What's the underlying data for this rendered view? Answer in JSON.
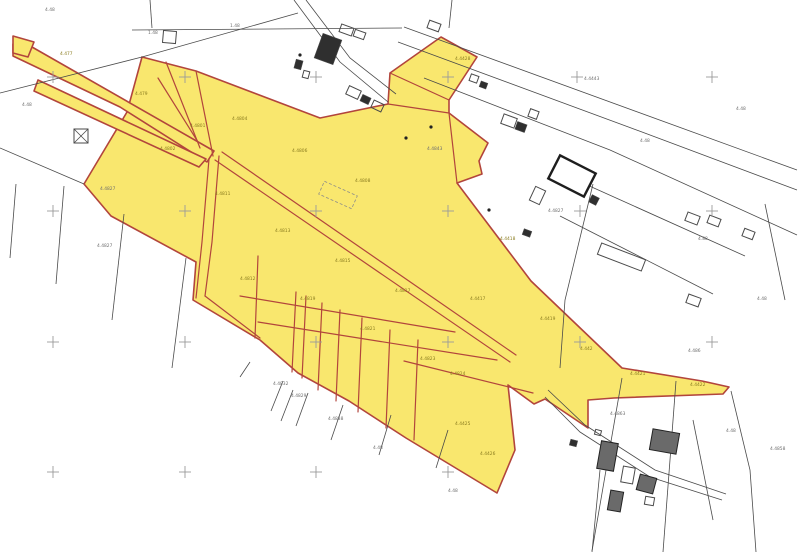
{
  "map": {
    "title": "cadastral-parcel-map",
    "canvas": {
      "width": 800,
      "height": 552,
      "background": "#ffffff"
    },
    "colors": {
      "parcel_fill": "#F9E76E",
      "parcel_stroke": "#B2453C",
      "line_black": "#4a4a4a",
      "cross_gray": "#9a9a9a",
      "label_white_area": "#6f6f6f",
      "label_yellow_area": "#8a7c1f",
      "building_fill": "#2f2f2f",
      "building_hatch": "#6a6a6a",
      "dashed_gray": "#8b8b8b"
    },
    "highlighted_parcels": [
      {
        "name": "main-parcel-block",
        "points": "142,57 196,71 320,118 388,104 390,73 441,37 477,57 449,100 449,113 488,143 479,161 482,174 457,183 531,281 622,368 702,381 729,387 723,394 614,398 588,400 588,428 545,399 534,404 508,385 515,450 497,493 406,438 349,401 298,373 260,340 193,300 196,262 111,216 84,184 127,112"
      },
      {
        "name": "strip-parcel-1",
        "points": "13,44 32,47 214,151 207,162 120,107 13,56"
      },
      {
        "name": "strip-parcel-2",
        "points": "38,80 206,159 199,167 34,91"
      },
      {
        "name": "corner-parcel",
        "points": "13,36 34,42 28,57 13,53"
      }
    ],
    "red_lines": [
      "196,71 213,156",
      "166,62 200,148",
      "158,78 198,142",
      "209,159 202,242 196,298",
      "219,156 212,242 205,296",
      "205,296 260,338",
      "215,160 510,362",
      "222,152 516,355",
      "388,104 449,113",
      "390,73 449,100",
      "258,256 255,338",
      "296,292 292,372",
      "306,296 302,378",
      "322,303 318,390",
      "340,310 336,401",
      "362,318 358,412",
      "390,330 386,428",
      "418,340 414,440",
      "240,296 455,332",
      "258,322 497,360",
      "404,361 533,393",
      "449,113 457,183"
    ],
    "black_lines": [
      "404,27 797,170",
      "398,42 642,132 797,190",
      "424,78 610,150 797,235",
      "294,0 340,62 388,102",
      "306,0 350,58 396,94",
      "0,93 142,57 298,13",
      "132,30 402,28",
      "150,0 152,28",
      "452,0 449,28",
      "0,148 84,184",
      "16,184 10,258",
      "64,186 56,284",
      "124,214 112,320",
      "186,258 172,368",
      "283,381 271,411",
      "293,390 281,421",
      "308,393 296,426",
      "343,405 331,440",
      "391,415 379,455",
      "448,430 436,468",
      "593,184 565,300 560,368",
      "560,216 713,294",
      "585,184 745,256",
      "765,204 785,300",
      "548,390 585,425 655,470 726,494",
      "545,397 580,432 650,477 722,500",
      "600,470 592,552",
      "622,378 592,551",
      "676,381 663,552",
      "731,391 750,470 756,552",
      "693,420 713,520",
      "240,377 250,362"
    ],
    "dashed_rects": [
      {
        "x": 320,
        "y": 188,
        "w": 36,
        "h": 14,
        "rot": 24
      }
    ],
    "buildings": [
      {
        "x": 318,
        "y": 36,
        "w": 20,
        "h": 26,
        "rot": 20,
        "style": "filled"
      },
      {
        "x": 340,
        "y": 26,
        "w": 13,
        "h": 8,
        "rot": 20,
        "style": "outline"
      },
      {
        "x": 354,
        "y": 31,
        "w": 11,
        "h": 7,
        "rot": 20,
        "style": "outline"
      },
      {
        "x": 295,
        "y": 60,
        "w": 7,
        "h": 9,
        "rot": 15,
        "style": "filled"
      },
      {
        "x": 303,
        "y": 71,
        "w": 6,
        "h": 7,
        "rot": 15,
        "style": "outline"
      },
      {
        "x": 347,
        "y": 88,
        "w": 13,
        "h": 9,
        "rot": 25,
        "style": "outline"
      },
      {
        "x": 361,
        "y": 96,
        "w": 9,
        "h": 7,
        "rot": 25,
        "style": "filled"
      },
      {
        "x": 372,
        "y": 102,
        "w": 11,
        "h": 8,
        "rot": 25,
        "style": "outline"
      },
      {
        "x": 163,
        "y": 31,
        "w": 13,
        "h": 12,
        "rot": 5,
        "style": "outline"
      },
      {
        "x": 74,
        "y": 129,
        "w": 14,
        "h": 14,
        "rot": 0,
        "style": "x"
      },
      {
        "x": 428,
        "y": 22,
        "w": 12,
        "h": 8,
        "rot": 20,
        "style": "outline"
      },
      {
        "x": 470,
        "y": 75,
        "w": 8,
        "h": 7,
        "rot": 20,
        "style": "outline"
      },
      {
        "x": 480,
        "y": 82,
        "w": 7,
        "h": 6,
        "rot": 20,
        "style": "filled"
      },
      {
        "x": 502,
        "y": 116,
        "w": 14,
        "h": 10,
        "rot": 20,
        "style": "outline"
      },
      {
        "x": 516,
        "y": 123,
        "w": 10,
        "h": 8,
        "rot": 20,
        "style": "filled"
      },
      {
        "x": 529,
        "y": 110,
        "w": 9,
        "h": 8,
        "rot": 20,
        "style": "outline"
      },
      {
        "x": 552,
        "y": 163,
        "w": 40,
        "h": 26,
        "rot": 27,
        "style": "thick"
      },
      {
        "x": 590,
        "y": 196,
        "w": 8,
        "h": 8,
        "rot": 27,
        "style": "filled"
      },
      {
        "x": 532,
        "y": 188,
        "w": 11,
        "h": 15,
        "rot": 25,
        "style": "outline"
      },
      {
        "x": 523,
        "y": 230,
        "w": 8,
        "h": 6,
        "rot": 20,
        "style": "filled"
      },
      {
        "x": 598,
        "y": 251,
        "w": 47,
        "h": 12,
        "rot": 21,
        "style": "outline"
      },
      {
        "x": 686,
        "y": 214,
        "w": 13,
        "h": 9,
        "rot": 21,
        "style": "outline"
      },
      {
        "x": 708,
        "y": 217,
        "w": 12,
        "h": 8,
        "rot": 21,
        "style": "outline"
      },
      {
        "x": 743,
        "y": 230,
        "w": 11,
        "h": 8,
        "rot": 21,
        "style": "outline"
      },
      {
        "x": 687,
        "y": 296,
        "w": 13,
        "h": 9,
        "rot": 20,
        "style": "outline"
      },
      {
        "x": 651,
        "y": 431,
        "w": 27,
        "h": 21,
        "rot": 10,
        "style": "hatched"
      },
      {
        "x": 599,
        "y": 442,
        "w": 17,
        "h": 28,
        "rot": 10,
        "style": "hatched"
      },
      {
        "x": 622,
        "y": 467,
        "w": 12,
        "h": 16,
        "rot": 10,
        "style": "outline"
      },
      {
        "x": 638,
        "y": 476,
        "w": 17,
        "h": 16,
        "rot": 15,
        "style": "hatched"
      },
      {
        "x": 609,
        "y": 491,
        "w": 13,
        "h": 20,
        "rot": 10,
        "style": "hatched"
      },
      {
        "x": 645,
        "y": 497,
        "w": 9,
        "h": 8,
        "rot": 10,
        "style": "outline"
      },
      {
        "x": 570,
        "y": 440,
        "w": 7,
        "h": 6,
        "rot": 15,
        "style": "filled"
      },
      {
        "x": 595,
        "y": 430,
        "w": 6,
        "h": 5,
        "rot": 15,
        "style": "outline"
      }
    ],
    "dots": [
      {
        "x": 431,
        "y": 127
      },
      {
        "x": 406,
        "y": 138
      },
      {
        "x": 489,
        "y": 210
      },
      {
        "x": 300,
        "y": 55
      }
    ],
    "survey_crosses": [
      {
        "x": 53,
        "y": 77
      },
      {
        "x": 185,
        "y": 77
      },
      {
        "x": 316,
        "y": 77
      },
      {
        "x": 448,
        "y": 77
      },
      {
        "x": 577,
        "y": 77
      },
      {
        "x": 712,
        "y": 77
      },
      {
        "x": 53,
        "y": 211
      },
      {
        "x": 185,
        "y": 211
      },
      {
        "x": 316,
        "y": 211
      },
      {
        "x": 448,
        "y": 211
      },
      {
        "x": 580,
        "y": 211
      },
      {
        "x": 712,
        "y": 211
      },
      {
        "x": 53,
        "y": 342
      },
      {
        "x": 185,
        "y": 342
      },
      {
        "x": 316,
        "y": 342
      },
      {
        "x": 448,
        "y": 342
      },
      {
        "x": 580,
        "y": 342
      },
      {
        "x": 712,
        "y": 342
      },
      {
        "x": 53,
        "y": 472
      },
      {
        "x": 185,
        "y": 472
      },
      {
        "x": 316,
        "y": 472
      },
      {
        "x": 448,
        "y": 472
      }
    ],
    "labels": [
      {
        "x": 45,
        "y": 11,
        "t": "4.48",
        "c": "w"
      },
      {
        "x": 148,
        "y": 34,
        "t": "1.48",
        "c": "w"
      },
      {
        "x": 230,
        "y": 27,
        "t": "1.48",
        "c": "w"
      },
      {
        "x": 584,
        "y": 80,
        "t": "4.4443",
        "c": "w"
      },
      {
        "x": 640,
        "y": 142,
        "t": "4.48",
        "c": "w"
      },
      {
        "x": 736,
        "y": 110,
        "t": "4.48",
        "c": "w"
      },
      {
        "x": 698,
        "y": 240,
        "t": "4.88",
        "c": "w"
      },
      {
        "x": 548,
        "y": 212,
        "t": "4.4827",
        "c": "w"
      },
      {
        "x": 427,
        "y": 150,
        "t": "4.4843",
        "c": "w"
      },
      {
        "x": 100,
        "y": 190,
        "t": "4.4827",
        "c": "w"
      },
      {
        "x": 22,
        "y": 106,
        "t": "4.48",
        "c": "w"
      },
      {
        "x": 97,
        "y": 247,
        "t": "4.4827",
        "c": "w"
      },
      {
        "x": 273,
        "y": 385,
        "t": "4.4832",
        "c": "w"
      },
      {
        "x": 291,
        "y": 397,
        "t": "4.4829",
        "c": "w"
      },
      {
        "x": 328,
        "y": 420,
        "t": "4.4838",
        "c": "w"
      },
      {
        "x": 373,
        "y": 449,
        "t": "4.48",
        "c": "w"
      },
      {
        "x": 448,
        "y": 492,
        "t": "4.48",
        "c": "w"
      },
      {
        "x": 610,
        "y": 415,
        "t": "4.4863",
        "c": "w"
      },
      {
        "x": 688,
        "y": 352,
        "t": "4.486",
        "c": "w"
      },
      {
        "x": 757,
        "y": 300,
        "t": "4.48",
        "c": "w"
      },
      {
        "x": 770,
        "y": 450,
        "t": "4.4858",
        "c": "w"
      },
      {
        "x": 726,
        "y": 432,
        "t": "4.48",
        "c": "w"
      },
      {
        "x": 60,
        "y": 55,
        "t": "4.477",
        "c": "y"
      },
      {
        "x": 135,
        "y": 95,
        "t": "4.479",
        "c": "y"
      },
      {
        "x": 190,
        "y": 127,
        "t": "4.4801",
        "c": "y"
      },
      {
        "x": 232,
        "y": 120,
        "t": "4.4804",
        "c": "y"
      },
      {
        "x": 292,
        "y": 152,
        "t": "4.4806",
        "c": "y"
      },
      {
        "x": 355,
        "y": 182,
        "t": "4.4808",
        "c": "y"
      },
      {
        "x": 215,
        "y": 195,
        "t": "4.4811",
        "c": "y"
      },
      {
        "x": 275,
        "y": 232,
        "t": "4.4813",
        "c": "y"
      },
      {
        "x": 335,
        "y": 262,
        "t": "4.4815",
        "c": "y"
      },
      {
        "x": 395,
        "y": 292,
        "t": "4.4817",
        "c": "y"
      },
      {
        "x": 300,
        "y": 300,
        "t": "4.4819",
        "c": "y"
      },
      {
        "x": 360,
        "y": 330,
        "t": "4.4821",
        "c": "y"
      },
      {
        "x": 420,
        "y": 360,
        "t": "4.4823",
        "c": "y"
      },
      {
        "x": 450,
        "y": 375,
        "t": "4.4824",
        "c": "y"
      },
      {
        "x": 470,
        "y": 300,
        "t": "4.4417",
        "c": "y"
      },
      {
        "x": 500,
        "y": 240,
        "t": "4.4418",
        "c": "y"
      },
      {
        "x": 540,
        "y": 320,
        "t": "4.4419",
        "c": "y"
      },
      {
        "x": 580,
        "y": 350,
        "t": "4.442",
        "c": "y"
      },
      {
        "x": 630,
        "y": 375,
        "t": "4.4421",
        "c": "y"
      },
      {
        "x": 690,
        "y": 386,
        "t": "4.4422",
        "c": "y"
      },
      {
        "x": 455,
        "y": 60,
        "t": "4.4428",
        "c": "y"
      },
      {
        "x": 455,
        "y": 425,
        "t": "4.4425",
        "c": "y"
      },
      {
        "x": 480,
        "y": 455,
        "t": "4.4426",
        "c": "y"
      },
      {
        "x": 160,
        "y": 150,
        "t": "4.4802",
        "c": "y"
      },
      {
        "x": 240,
        "y": 280,
        "t": "4.4812",
        "c": "y"
      }
    ]
  }
}
